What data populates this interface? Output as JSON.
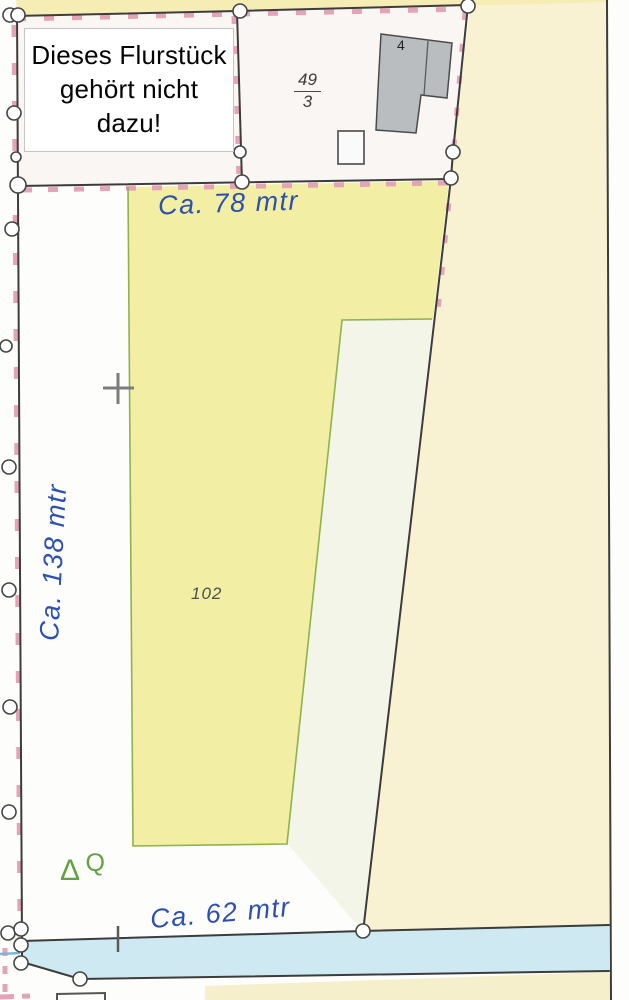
{
  "note_box": {
    "line1": "Dieses Flurstück",
    "line2": "gehört nicht dazu!"
  },
  "parcel_49_3": {
    "numerator": "49",
    "denominator": "3"
  },
  "building": {
    "house_number": "4"
  },
  "parcel_102": {
    "label": "102"
  },
  "measurements": {
    "top_edge": "Ca. 78 mtr",
    "left_edge": "Ca. 138 mtr",
    "bottom_edge": "Ca. 62 mtr"
  },
  "symbols": {
    "triangle": "Δ",
    "q_mark": "Q"
  },
  "colors": {
    "parcel_yellow": "#f2efa4",
    "adjacent_cream": "#f8f2d3",
    "top_strip_yellow": "#f6edb4",
    "inner_pale": "#f3f5e9",
    "water_cyan": "#cfe9f3",
    "boundary_green": "#8fb14e",
    "handwriting_blue": "#2d4fae",
    "building_gray": "#b9bdc0",
    "survey_pink": "#e4a4b8",
    "boundary_black": "#3c3c3c"
  }
}
